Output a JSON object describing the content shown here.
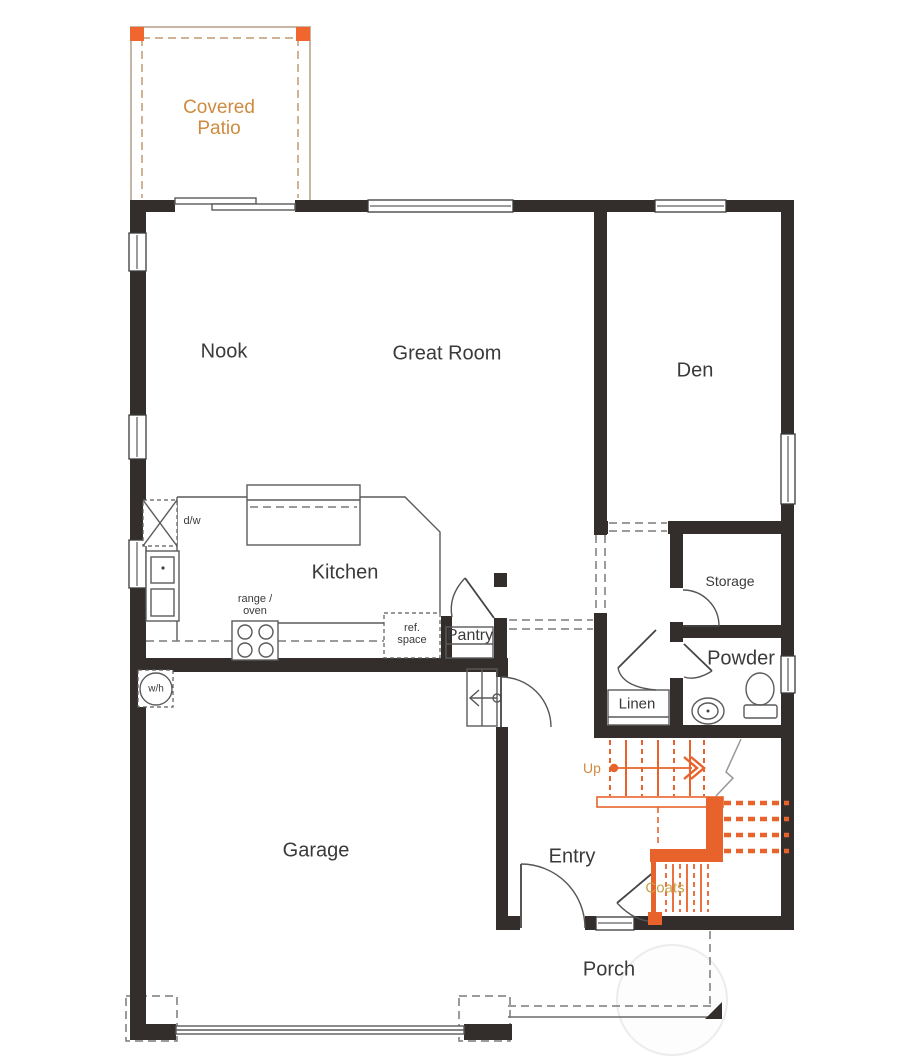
{
  "colors": {
    "wall": "#332e2b",
    "stairs": "#e8632c",
    "post": "#f1662f",
    "label": "#3a3a3a",
    "patio_text": "#cf8b3f",
    "up_text": "#cf8b3f",
    "coats_text": "#c8a04c"
  },
  "rooms": {
    "covered_patio": {
      "line1": "Covered",
      "line2": "Patio"
    },
    "nook": "Nook",
    "great_room": "Great Room",
    "den": "Den",
    "kitchen": "Kitchen",
    "pantry": "Pantry",
    "storage": "Storage",
    "powder": "Powder",
    "linen": "Linen",
    "garage": "Garage",
    "entry": "Entry",
    "porch": "Porch",
    "coats": "Coats"
  },
  "annotations": {
    "up": "Up",
    "dw": "d/w",
    "range_line1": "range /",
    "range_line2": "oven",
    "ref_line1": "ref.",
    "ref_line2": "space",
    "wh": "w/h"
  }
}
